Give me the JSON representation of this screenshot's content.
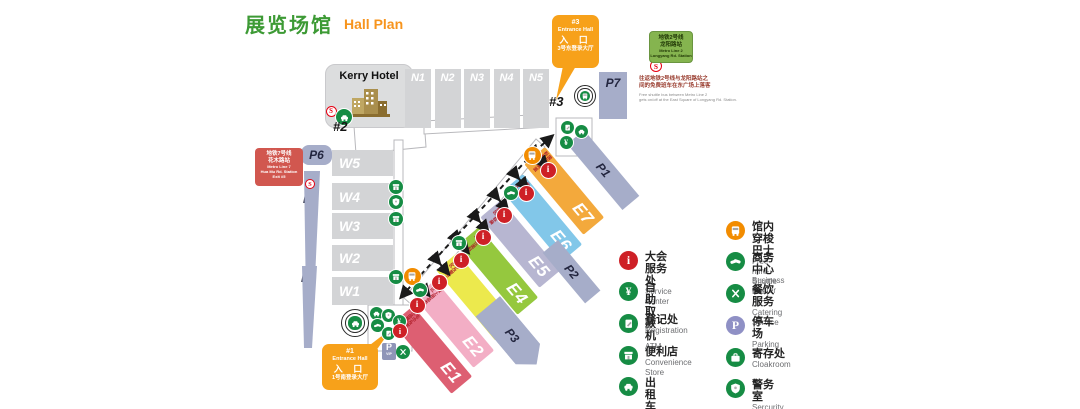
{
  "title": {
    "cn": "展览场馆",
    "en": "Hall Plan"
  },
  "kerry_hotel": {
    "label": "Kerry Hotel"
  },
  "north_halls": [
    "N1",
    "N2",
    "N3",
    "N4",
    "N5"
  ],
  "west_halls": [
    "W5",
    "W4",
    "W3",
    "W2",
    "W1"
  ],
  "east_halls": [
    {
      "id": "E1",
      "color": "#dd5f72",
      "label_cn": "毛巾及家纺成品展区"
    },
    {
      "id": "E2",
      "color": "#f3aec5",
      "label_cn": "床上用品类展区"
    },
    {
      "id": "E3",
      "color": "#ece94d",
      "label_cn": "布艺及窗帘类展区"
    },
    {
      "id": "E4",
      "color": "#95c83e",
      "label_cn": "功能性面料展区"
    },
    {
      "id": "E5",
      "color": "#b7b6d1",
      "label_cn": "墙纸及软装类展区"
    },
    {
      "id": "E6",
      "color": "#82c7e9",
      "label_cn": "地毯及地垫类展区"
    },
    {
      "id": "E7",
      "color": "#f3a93c",
      "label_cn": "国际品牌面料展区"
    }
  ],
  "parking": {
    "p1": "P1",
    "p2": "P2",
    "p3": "P3",
    "p4": "P4",
    "p5": "P5",
    "p6": "P6",
    "p7": "P7"
  },
  "entrance1": {
    "no": "#1",
    "en": "Entrance Hall",
    "cn": "入 口",
    "desc": "1号南登录大厅"
  },
  "entrance3": {
    "no": "#3",
    "en": "Entrance Hall",
    "cn": "入 口",
    "desc": "3号东登录大厅"
  },
  "entrance2_label": "#2",
  "entrance3_label": "#3",
  "metro_line2_badge": {
    "l1": "地铁2号线",
    "l2": "龙阳路站",
    "l3": "Metro Line 2",
    "l4": "Longyang Rd. Station"
  },
  "metro_line7_badge": {
    "l1": "地铁7号线",
    "l2": "花木路站",
    "l3": "Metro Line 7",
    "l4": "Hua Mu Rd. Station",
    "l5": "Exit #5"
  },
  "shuttle_note": {
    "cn1": "往返地铁2号线与龙阳路站之",
    "cn2": "间的免费班车在东广场上落客",
    "en1": "Free shuttle bus between Metro Line 2",
    "en2": "gets on/off at the East Square of Longyang Rd. Station."
  },
  "pvip": {
    "p": "P",
    "vip": "VIP"
  },
  "legend": {
    "left": [
      {
        "icon": "service-center-icon",
        "glyph": "info",
        "variant": "red",
        "cn": "大会服务处",
        "en": "Service Center"
      },
      {
        "icon": "atm-icon",
        "glyph": "atm",
        "variant": "green",
        "cn": "自助取款机",
        "en": "ATM"
      },
      {
        "icon": "registration-icon",
        "glyph": "pad",
        "variant": "green",
        "cn": "登记处",
        "en": "Registration"
      },
      {
        "icon": "convenience-store-icon",
        "glyph": "store",
        "variant": "green",
        "cn": "便利店",
        "en": "Convenience Store"
      },
      {
        "icon": "taxi-icon",
        "glyph": "car",
        "variant": "green",
        "cn": "出租车",
        "en": "Taxi"
      }
    ],
    "right": [
      {
        "icon": "shuttle-bus-icon",
        "glyph": "bus",
        "variant": "orange",
        "cn": "馆内穿梭巴士",
        "en": "Free mini-Shuttle Bus"
      },
      {
        "icon": "business-center-icon",
        "glyph": "handshake",
        "variant": "green",
        "cn": "商务中心",
        "en": "Business Center"
      },
      {
        "icon": "catering-icon",
        "glyph": "utensils",
        "variant": "green",
        "cn": "餐饮服务",
        "en": "Catering Service"
      },
      {
        "icon": "parking-icon",
        "glyph": "parking",
        "variant": "purple",
        "cn": "停车场",
        "en": "Parking"
      },
      {
        "icon": "cloakroom-icon",
        "glyph": "briefcase",
        "variant": "green",
        "cn": "寄存处",
        "en": "Cloakroom"
      },
      {
        "icon": "security-icon",
        "glyph": "shield",
        "variant": "green",
        "cn": "警务室",
        "en": "Sercurity Office"
      }
    ]
  },
  "map_icons": [
    {
      "name": "metro-icon",
      "glyph": "metro",
      "variant": "metro",
      "x": 331,
      "y": 111,
      "size": 11
    },
    {
      "name": "taxi-icon",
      "glyph": "car",
      "variant": "green",
      "x": 344,
      "y": 117,
      "size": 16
    },
    {
      "name": "metro-icon",
      "glyph": "metro",
      "variant": "metro",
      "x": 310,
      "y": 184,
      "size": 10
    },
    {
      "name": "metro-icon",
      "glyph": "metro",
      "variant": "metro",
      "x": 656,
      "y": 66,
      "size": 12
    },
    {
      "name": "convenience-store-icon",
      "glyph": "store",
      "variant": "green",
      "x": 396,
      "y": 187,
      "size": 14
    },
    {
      "name": "security-icon",
      "glyph": "shield",
      "variant": "green",
      "x": 396,
      "y": 202,
      "size": 14
    },
    {
      "name": "convenience-store-icon",
      "glyph": "store",
      "variant": "green",
      "x": 396,
      "y": 219,
      "size": 14
    },
    {
      "name": "convenience-store-icon",
      "glyph": "store",
      "variant": "green",
      "x": 396,
      "y": 277,
      "size": 14
    },
    {
      "name": "shuttle-bus-icon",
      "glyph": "bus",
      "variant": "orange",
      "x": 412,
      "y": 276,
      "size": 17
    },
    {
      "name": "business-center-icon",
      "glyph": "handshake",
      "variant": "green",
      "x": 420,
      "y": 290,
      "size": 14
    },
    {
      "name": "business-center-icon",
      "glyph": "handshake",
      "variant": "green",
      "x": 511,
      "y": 193,
      "size": 14
    },
    {
      "name": "convenience-store-icon",
      "glyph": "store",
      "variant": "green",
      "x": 459,
      "y": 243,
      "size": 14
    },
    {
      "name": "shuttle-bus-icon",
      "glyph": "bus",
      "variant": "orange",
      "x": 532,
      "y": 155,
      "size": 17
    },
    {
      "name": "registration-icon",
      "glyph": "pad",
      "variant": "green",
      "x": 567,
      "y": 127,
      "size": 13
    },
    {
      "name": "taxi-icon",
      "glyph": "car",
      "variant": "green",
      "x": 581,
      "y": 131,
      "size": 13
    },
    {
      "name": "atm-icon",
      "glyph": "atm",
      "variant": "green",
      "x": 566,
      "y": 142,
      "size": 13
    },
    {
      "name": "service-center-icon",
      "glyph": "info",
      "variant": "red",
      "x": 417,
      "y": 305,
      "size": 15
    },
    {
      "name": "service-center-icon",
      "glyph": "info",
      "variant": "red",
      "x": 439,
      "y": 282,
      "size": 15
    },
    {
      "name": "service-center-icon",
      "glyph": "info",
      "variant": "red",
      "x": 461,
      "y": 260,
      "size": 15
    },
    {
      "name": "service-center-icon",
      "glyph": "info",
      "variant": "red",
      "x": 483,
      "y": 237,
      "size": 15
    },
    {
      "name": "service-center-icon",
      "glyph": "info",
      "variant": "red",
      "x": 504,
      "y": 215,
      "size": 15
    },
    {
      "name": "service-center-icon",
      "glyph": "info",
      "variant": "red",
      "x": 526,
      "y": 193,
      "size": 15
    },
    {
      "name": "service-center-icon",
      "glyph": "info",
      "variant": "red",
      "x": 548,
      "y": 170,
      "size": 15
    },
    {
      "name": "taxi-icon",
      "glyph": "car",
      "variant": "green",
      "x": 376,
      "y": 313,
      "size": 13
    },
    {
      "name": "security-icon",
      "glyph": "shield",
      "variant": "green",
      "x": 388,
      "y": 315,
      "size": 13
    },
    {
      "name": "atm-icon",
      "glyph": "atm",
      "variant": "green",
      "x": 399,
      "y": 321,
      "size": 13
    },
    {
      "name": "business-center-icon",
      "glyph": "handshake",
      "variant": "green",
      "x": 377,
      "y": 325,
      "size": 13
    },
    {
      "name": "registration-icon",
      "glyph": "pad",
      "variant": "green",
      "x": 388,
      "y": 333,
      "size": 13
    },
    {
      "name": "service-center-icon",
      "glyph": "info",
      "variant": "red",
      "x": 400,
      "y": 331,
      "size": 14
    },
    {
      "name": "catering-icon",
      "glyph": "utensils",
      "variant": "green",
      "x": 403,
      "y": 352,
      "size": 14
    },
    {
      "name": "taxi-pickup-icon",
      "glyph": "car",
      "variant": "ring",
      "x": 355,
      "y": 323,
      "size": 28
    },
    {
      "name": "shuttle-pickup-icon",
      "glyph": "bus",
      "variant": "ring",
      "x": 585,
      "y": 96,
      "size": 22
    }
  ],
  "colors": {
    "title_green": "#3d9a35",
    "title_orange": "#f7941d",
    "hall_gray": "#d3d4d6",
    "slate": "#a6adc9",
    "green_icon": "#168c44",
    "red_icon": "#ce2026",
    "orange_icon": "#f28c00",
    "purple_icon": "#8f90c5",
    "metro_red": "#e60012",
    "balloon_orange": "#f7a11a",
    "line7_badge": "#d1574f",
    "line2_badge": "#85b44f"
  }
}
